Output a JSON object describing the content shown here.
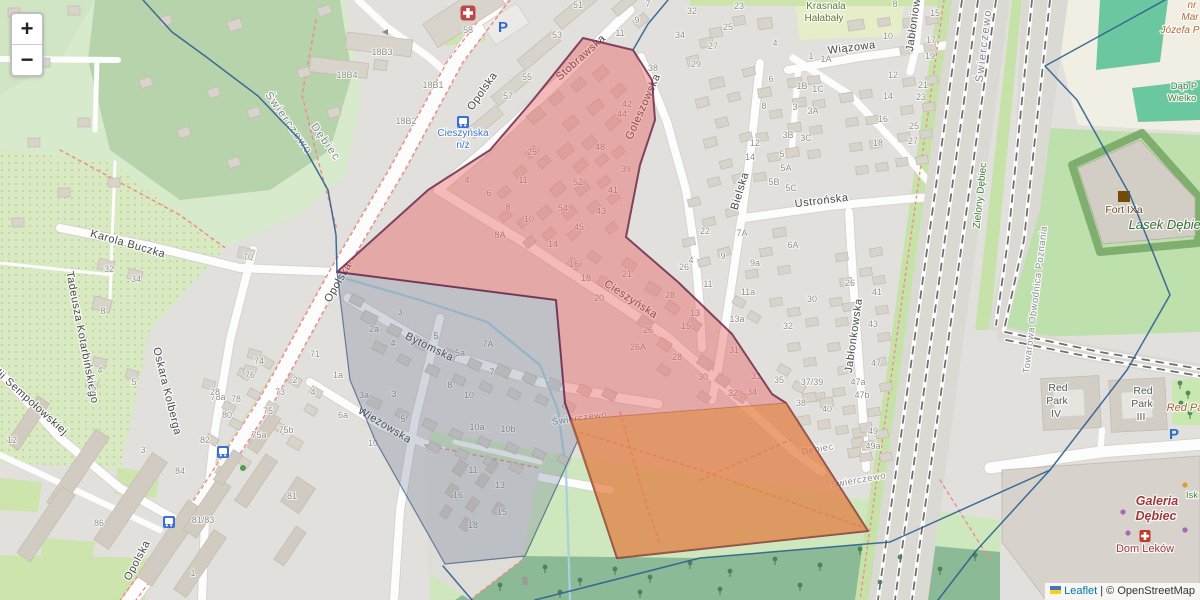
{
  "zoom_control": {
    "zoom_in": "+",
    "zoom_out": "−"
  },
  "attribution": {
    "leaflet_label": "Leaflet",
    "separator": " | ",
    "osm_label": "© OpenStreetMap",
    "leaflet_link_color": "#0078A8"
  },
  "map": {
    "colors": {
      "red_fill": "#e85a5a",
      "red_fill_opacity": 0.42,
      "red_stroke": "#6f2b4e",
      "orange_fill": "#e0862f",
      "orange_fill_opacity": 0.5,
      "orange_stroke": "#a05a30",
      "grey_fill": "#5f6e8c",
      "grey_fill_opacity": 0.27,
      "grey_stroke": "#3f5f85",
      "boundary": "#2d5f8e",
      "water": "#a8d0dd",
      "path_red": "#ef8a8a"
    },
    "street_labels": [
      {
        "t": "Opolska",
        "x": 485,
        "y": 93,
        "r": -55,
        "cls": "street"
      },
      {
        "t": "Opolska",
        "x": 341,
        "y": 284,
        "r": -60,
        "cls": "street"
      },
      {
        "t": "Opolska",
        "x": 140,
        "y": 562,
        "r": -62,
        "cls": "street"
      },
      {
        "t": "Stobrawska",
        "x": 583,
        "y": 60,
        "r": -42,
        "cls": "street"
      },
      {
        "t": "Goleszowska",
        "x": 646,
        "y": 108,
        "r": -66,
        "cls": "street"
      },
      {
        "t": "Cieszyńska",
        "x": 629,
        "y": 302,
        "r": 33,
        "cls": "street"
      },
      {
        "t": "Bielska",
        "x": 743,
        "y": 192,
        "r": -73,
        "cls": "street"
      },
      {
        "t": "Ustrońska",
        "x": 822,
        "y": 204,
        "r": -7,
        "cls": "street"
      },
      {
        "t": "Wiązowa",
        "x": 852,
        "y": 51,
        "r": -7,
        "cls": "street"
      },
      {
        "t": "Jabłoniowa",
        "x": 917,
        "y": 22,
        "r": -82,
        "cls": "street"
      },
      {
        "t": "Jabłonkowska",
        "x": 857,
        "y": 336,
        "r": -82,
        "cls": "street"
      },
      {
        "t": "Bytomska",
        "x": 428,
        "y": 350,
        "r": 26,
        "cls": "street"
      },
      {
        "t": "Wieżowska",
        "x": 383,
        "y": 428,
        "r": 31,
        "cls": "street"
      },
      {
        "t": "Karola Buczka",
        "x": 127,
        "y": 247,
        "r": 16,
        "cls": "street"
      },
      {
        "t": "Tadeusza Kotarbińskiego",
        "x": 79,
        "y": 338,
        "r": 79,
        "cls": "street"
      },
      {
        "t": "Oskara Kolberga",
        "x": 164,
        "y": 392,
        "r": 76,
        "cls": "street"
      },
      {
        "t": "Emilii Sempołowskiej",
        "x": 22,
        "y": 398,
        "r": 42,
        "cls": "street"
      },
      {
        "t": "Świerczewo",
        "x": 286,
        "y": 125,
        "r": 55,
        "cls": "district"
      },
      {
        "t": "Dębiec",
        "x": 323,
        "y": 144,
        "r": 55,
        "cls": "district"
      },
      {
        "t": "Świerczewo",
        "x": 987,
        "y": 46,
        "r": -83,
        "cls": "district"
      },
      {
        "t": "Świerczewo",
        "x": 580,
        "y": 421,
        "r": -8,
        "cls": "place"
      },
      {
        "t": "Dębiec",
        "x": 818,
        "y": 452,
        "r": -10,
        "cls": "place"
      },
      {
        "t": "Świerczewo",
        "x": 859,
        "y": 483,
        "r": -10,
        "cls": "place"
      },
      {
        "t": "Zielony Dębiec",
        "x": 983,
        "y": 196,
        "r": -84,
        "cls": "green"
      },
      {
        "t": "Towarowa Obwodnica Poznania",
        "x": 1038,
        "y": 300,
        "r": -83,
        "cls": "rail"
      }
    ],
    "poi_labels": [
      {
        "t": "Krasnala",
        "x": 826,
        "y": 9,
        "cls": "park"
      },
      {
        "t": "Hałabały",
        "x": 824,
        "y": 21,
        "cls": "park"
      },
      {
        "t": "Lasek Dębiec",
        "x": 1168,
        "y": 229,
        "cls": "green-it"
      },
      {
        "t": "Dąb P",
        "x": 1184,
        "y": 89,
        "cls": "green-sm"
      },
      {
        "t": "Wielko",
        "x": 1182,
        "y": 101,
        "cls": "green-sm"
      },
      {
        "t": "Isk",
        "x": 1192,
        "y": 498,
        "cls": "green-sm"
      },
      {
        "t": "Fort IXa",
        "x": 1124,
        "y": 213,
        "cls": "fort"
      },
      {
        "t": "Red",
        "x": 1058,
        "y": 391,
        "cls": "bldg"
      },
      {
        "t": "Park",
        "x": 1057,
        "y": 404,
        "cls": "bldg"
      },
      {
        "t": "IV",
        "x": 1056,
        "y": 417,
        "cls": "bldg"
      },
      {
        "t": "Red",
        "x": 1143,
        "y": 394,
        "cls": "bldg"
      },
      {
        "t": "Park",
        "x": 1142,
        "y": 407,
        "cls": "bldg"
      },
      {
        "t": "III",
        "x": 1141,
        "y": 420,
        "cls": "bldg"
      },
      {
        "t": "Red Pa",
        "x": 1185,
        "y": 411,
        "cls": "brown-it"
      },
      {
        "t": "Galeria",
        "x": 1157,
        "y": 505,
        "cls": "mall"
      },
      {
        "t": "Dębiec",
        "x": 1156,
        "y": 520,
        "cls": "mall"
      },
      {
        "t": "Dom Leków",
        "x": 1145,
        "y": 552,
        "cls": "pharm"
      },
      {
        "t": "nr",
        "x": 1192,
        "y": 8,
        "cls": "brown-sm"
      },
      {
        "t": "Mar",
        "x": 1190,
        "y": 20,
        "cls": "brown-sm"
      },
      {
        "t": "Józefa P",
        "x": 1180,
        "y": 33,
        "cls": "brown-sm"
      },
      {
        "t": "Cieszyńska",
        "x": 463,
        "y": 136,
        "cls": "transit"
      },
      {
        "t": "n/ż",
        "x": 463,
        "y": 148,
        "cls": "transit"
      }
    ],
    "house_numbers": [
      [
        "51",
        578,
        8
      ],
      [
        "53",
        557,
        38
      ],
      [
        "55",
        527,
        80
      ],
      [
        "57",
        508,
        99
      ],
      [
        "58",
        468,
        33
      ],
      [
        "18B3",
        382,
        55
      ],
      [
        "18B4",
        347,
        78
      ],
      [
        "18B1",
        433,
        88
      ],
      [
        "18B2",
        406,
        124
      ],
      [
        "7",
        648,
        7
      ],
      [
        "9",
        637,
        23
      ],
      [
        "11",
        620,
        36
      ],
      [
        "32",
        692,
        14
      ],
      [
        "34",
        680,
        38
      ],
      [
        "38",
        653,
        71
      ],
      [
        "23",
        739,
        9
      ],
      [
        "25",
        728,
        30
      ],
      [
        "27",
        713,
        49
      ],
      [
        "29",
        696,
        67
      ],
      [
        "4",
        775,
        46
      ],
      [
        "6",
        771,
        82
      ],
      [
        "8",
        764,
        109
      ],
      [
        "12",
        755,
        146
      ],
      [
        "14",
        750,
        160
      ],
      [
        "1",
        811,
        59
      ],
      [
        "1A",
        826,
        62
      ],
      [
        "1B",
        802,
        89
      ],
      [
        "1C",
        818,
        92
      ],
      [
        "3",
        795,
        110
      ],
      [
        "3A",
        813,
        114
      ],
      [
        "3B",
        788,
        138
      ],
      [
        "3C",
        806,
        141
      ],
      [
        "8",
        895,
        7
      ],
      [
        "10",
        888,
        39
      ],
      [
        "12",
        893,
        78
      ],
      [
        "14",
        888,
        99
      ],
      [
        "16",
        883,
        122
      ],
      [
        "18",
        878,
        146
      ],
      [
        "15",
        935,
        16
      ],
      [
        "17",
        931,
        43
      ],
      [
        "19",
        930,
        59
      ],
      [
        "21",
        923,
        88
      ],
      [
        "23",
        921,
        100
      ],
      [
        "25",
        914,
        129
      ],
      [
        "27",
        913,
        144
      ],
      [
        "42",
        627,
        107
      ],
      [
        "44",
        622,
        117
      ],
      [
        "48",
        600,
        150
      ],
      [
        "39",
        626,
        172
      ],
      [
        "41",
        613,
        193
      ],
      [
        "43",
        601,
        214
      ],
      [
        "25",
        532,
        155
      ],
      [
        "11",
        523,
        183
      ],
      [
        "52",
        578,
        185
      ],
      [
        "54",
        563,
        211
      ],
      [
        "45",
        579,
        230
      ],
      [
        "5",
        782,
        157
      ],
      [
        "5A",
        786,
        171
      ],
      [
        "5B",
        774,
        185
      ],
      [
        "5C",
        791,
        191
      ],
      [
        "22",
        705,
        234
      ],
      [
        "7A",
        742,
        236
      ],
      [
        "6A",
        793,
        248
      ],
      [
        "9",
        723,
        259
      ],
      [
        "9a",
        755,
        266
      ],
      [
        "11",
        708,
        287
      ],
      [
        "11a",
        748,
        295
      ],
      [
        "4",
        691,
        263
      ],
      [
        "26",
        684,
        270
      ],
      [
        "13",
        695,
        316
      ],
      [
        "13a",
        737,
        322
      ],
      [
        "15",
        686,
        329
      ],
      [
        "31",
        734,
        353
      ],
      [
        "32",
        788,
        329
      ],
      [
        "33",
        756,
        379
      ],
      [
        "35",
        779,
        383
      ],
      [
        "37/39",
        812,
        385
      ],
      [
        "38",
        801,
        406
      ],
      [
        "40",
        827,
        412
      ],
      [
        "49",
        873,
        434
      ],
      [
        "49a",
        873,
        449
      ],
      [
        "47b",
        862,
        398
      ],
      [
        "47a",
        858,
        385
      ],
      [
        "47",
        876,
        366
      ],
      [
        "43",
        873,
        327
      ],
      [
        "41",
        877,
        295
      ],
      [
        "26",
        850,
        286
      ],
      [
        "30",
        812,
        302
      ],
      [
        "8",
        508,
        210
      ],
      [
        "10",
        529,
        222
      ],
      [
        "8A",
        500,
        238
      ],
      [
        "14",
        553,
        247
      ],
      [
        "16",
        574,
        267
      ],
      [
        "18",
        586,
        281
      ],
      [
        "20",
        599,
        301
      ],
      [
        "21",
        627,
        277
      ],
      [
        "26",
        648,
        333
      ],
      [
        "26A",
        638,
        350
      ],
      [
        "28",
        670,
        298
      ],
      [
        "28",
        677,
        360
      ],
      [
        "30",
        703,
        380
      ],
      [
        "32",
        733,
        396
      ],
      [
        "34",
        752,
        395
      ],
      [
        "4",
        467,
        183
      ],
      [
        "6",
        489,
        196
      ],
      [
        "2a",
        374,
        332
      ],
      [
        "4",
        393,
        346
      ],
      [
        "3",
        400,
        315
      ],
      [
        "5",
        436,
        339
      ],
      [
        "5a",
        460,
        356
      ],
      [
        "7A",
        488,
        347
      ],
      [
        "7",
        492,
        375
      ],
      [
        "8",
        450,
        388
      ],
      [
        "10",
        469,
        398
      ],
      [
        "3a",
        364,
        398
      ],
      [
        "3",
        394,
        397
      ],
      [
        "5",
        403,
        422
      ],
      [
        "10a",
        477,
        430
      ],
      [
        "10b",
        508,
        432
      ],
      [
        "1a",
        338,
        378
      ],
      [
        "71",
        315,
        357
      ],
      [
        "73",
        280,
        395
      ],
      [
        "75",
        268,
        414
      ],
      [
        "75b",
        286,
        433
      ],
      [
        "75a",
        259,
        438
      ],
      [
        "2",
        295,
        383
      ],
      [
        "4",
        313,
        395
      ],
      [
        "6a",
        343,
        418
      ],
      [
        "10",
        373,
        446
      ],
      [
        "74",
        259,
        364
      ],
      [
        "76",
        250,
        378
      ],
      [
        "78a",
        218,
        400
      ],
      [
        "78",
        236,
        402
      ],
      [
        "80",
        227,
        418
      ],
      [
        "82",
        205,
        443
      ],
      [
        "84",
        180,
        474
      ],
      [
        "32",
        109,
        272
      ],
      [
        "34",
        136,
        282
      ],
      [
        "8",
        103,
        314
      ],
      [
        "70",
        248,
        260
      ],
      [
        "4",
        100,
        373
      ],
      [
        "5",
        134,
        385
      ],
      [
        "2",
        94,
        393
      ],
      [
        "28",
        215,
        395
      ],
      [
        "12",
        12,
        443
      ],
      [
        "86",
        99,
        526
      ],
      [
        "81",
        292,
        499
      ],
      [
        "81/83",
        203,
        523
      ],
      [
        "1",
        193,
        576
      ],
      [
        "3",
        143,
        453
      ],
      [
        "11",
        473,
        473
      ],
      [
        "13",
        500,
        488
      ],
      [
        "16",
        458,
        498
      ],
      [
        "15",
        502,
        515
      ],
      [
        "18",
        473,
        528
      ]
    ],
    "icons": [
      {
        "n": "hospital-icon",
        "x": 468,
        "y": 13
      },
      {
        "n": "parking-icon",
        "x": 503,
        "y": 27
      },
      {
        "n": "parking-icon",
        "x": 1174,
        "y": 434
      },
      {
        "n": "bus-stop-icon",
        "x": 463,
        "y": 122
      },
      {
        "n": "bus-stop-icon",
        "x": 223,
        "y": 452
      },
      {
        "n": "bus-stop-icon",
        "x": 169,
        "y": 522
      },
      {
        "n": "castle-icon",
        "x": 1124,
        "y": 197
      },
      {
        "n": "pharmacy-icon",
        "x": 1145,
        "y": 536
      },
      {
        "n": "tree-icon",
        "x": 243,
        "y": 468
      },
      {
        "n": "shop-dot-icon",
        "x": 1123,
        "y": 512
      },
      {
        "n": "shop-dot-icon",
        "x": 1128,
        "y": 533
      },
      {
        "n": "shop-dot-icon",
        "x": 1185,
        "y": 530
      },
      {
        "n": "poi-dot-icon",
        "x": 1185,
        "y": 485
      },
      {
        "n": "oneway-arrow-icon",
        "x": 386,
        "y": 32
      },
      {
        "n": "shrine-icon",
        "x": 525,
        "y": 581
      }
    ]
  }
}
